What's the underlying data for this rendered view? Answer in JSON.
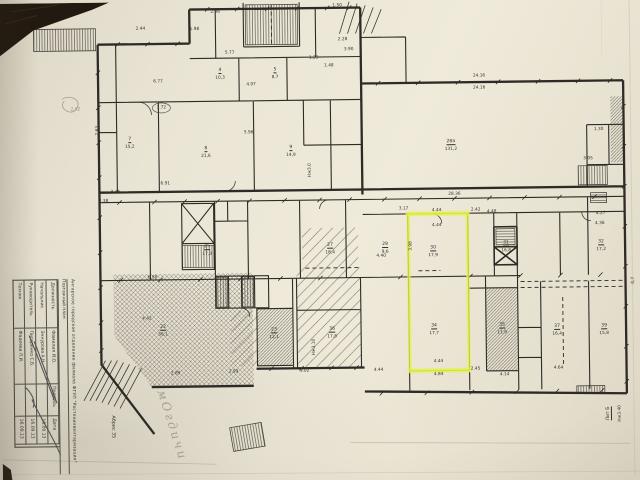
{
  "photo": {
    "background_color": "#1e1811",
    "paper_color": "#eae5d5",
    "ink_color": "#2e2b26",
    "highlight_color": "#e4f450"
  },
  "annotations": {
    "handwritten_note": "мОгдичи"
  },
  "titleblock": {
    "org_line": "Ангарское городское отделение филиала ФГУП \"Ростехинвентаризация\"",
    "doc_line": "Поэтажный план",
    "headers": [
      "Должность",
      "Фамилия И.О.",
      "Подпись",
      "Дата"
    ],
    "rows": [
      {
        "role": "Начальник",
        "name": "Эннурова А.Н.",
        "sign": "",
        "date": "16.09.13"
      },
      {
        "role": "Руководитель",
        "name": "Пигоренко С.Б.",
        "sign": "",
        "date": "16.09.13"
      },
      {
        "role": "Техник",
        "name": "Фадеева Л.И.",
        "sign": "",
        "date": "16.09.13"
      }
    ],
    "abris": "Абрис 35"
  },
  "plan": {
    "labels": [
      {
        "t": "2.86",
        "x": 218,
        "y": 11
      },
      {
        "t": "1.50",
        "x": 340,
        "y": 6
      },
      {
        "t": "2.44",
        "x": 143,
        "y": 27
      },
      {
        "t": "1.98",
        "x": 197,
        "y": 28
      },
      {
        "t": "2.28",
        "x": 345,
        "y": 40
      },
      {
        "t": "3.90",
        "x": 351,
        "y": 50
      },
      {
        "t": "5.77",
        "x": 232,
        "y": 52
      },
      {
        "t": "1.23",
        "x": 316,
        "y": 58
      },
      {
        "t": "1.48",
        "x": 331,
        "y": 66
      },
      {
        "t": "4",
        "x": 222,
        "y": 70,
        "c": "rm"
      },
      {
        "t": "10,3",
        "x": 222,
        "y": 77
      },
      {
        "t": "5",
        "x": 277,
        "y": 70,
        "c": "rm"
      },
      {
        "t": "8,7",
        "x": 277,
        "y": 77
      },
      {
        "t": "6.77",
        "x": 160,
        "y": 80
      },
      {
        "t": "4.97",
        "x": 253,
        "y": 84
      },
      {
        "t": "24.16",
        "x": 481,
        "y": 78
      },
      {
        "t": "24.16",
        "x": 481,
        "y": 90
      },
      {
        "t": "1,92",
        "x": 77,
        "y": 107,
        "c": "pencil"
      },
      {
        "t": "1.72",
        "x": 163,
        "y": 106
      },
      {
        "t": "2.63",
        "x": 99,
        "y": 128,
        "r": -90
      },
      {
        "t": "5.96",
        "x": 250,
        "y": 132
      },
      {
        "t": "1.30",
        "x": 600,
        "y": 133
      },
      {
        "t": "7",
        "x": 131,
        "y": 138,
        "c": "rm"
      },
      {
        "t": "15,2",
        "x": 131,
        "y": 145
      },
      {
        "t": "28а",
        "x": 452,
        "y": 144,
        "c": "rm"
      },
      {
        "t": "131,2",
        "x": 452,
        "y": 151
      },
      {
        "t": "8",
        "x": 207,
        "y": 148,
        "c": "rm"
      },
      {
        "t": "21,6",
        "x": 207,
        "y": 155
      },
      {
        "t": "9",
        "x": 292,
        "y": 148,
        "c": "rm"
      },
      {
        "t": "14,9",
        "x": 292,
        "y": 155
      },
      {
        "t": "3.05",
        "x": 589,
        "y": 162
      },
      {
        "t": "Нж3.0",
        "x": 311,
        "y": 170,
        "r": -90
      },
      {
        "t": "6.91",
        "x": 166,
        "y": 182
      },
      {
        "t": "3.45",
        "x": 116,
        "y": 190
      },
      {
        "t": "2.38",
        "x": 104,
        "y": 199
      },
      {
        "t": "28.36",
        "x": 455,
        "y": 196
      },
      {
        "t": "3.17",
        "x": 404,
        "y": 210
      },
      {
        "t": "4.44",
        "x": 437,
        "y": 212
      },
      {
        "t": "2.42",
        "x": 476,
        "y": 212
      },
      {
        "t": "4.48",
        "x": 492,
        "y": 214
      },
      {
        "t": "4.27",
        "x": 601,
        "y": 217
      },
      {
        "t": "4.36",
        "x": 600,
        "y": 227
      },
      {
        "t": "4.44",
        "x": 437,
        "y": 227
      },
      {
        "t": "25",
        "x": 207,
        "y": 246,
        "c": "rm"
      },
      {
        "t": "17,3",
        "x": 207,
        "y": 253
      },
      {
        "t": "27",
        "x": 330,
        "y": 246,
        "c": "rm"
      },
      {
        "t": "18,4",
        "x": 330,
        "y": 253
      },
      {
        "t": "29",
        "x": 385,
        "y": 246,
        "c": "rm"
      },
      {
        "t": "9,6",
        "x": 385,
        "y": 253
      },
      {
        "t": "30",
        "x": 433,
        "y": 250,
        "c": "rm"
      },
      {
        "t": "17,9",
        "x": 433,
        "y": 257
      },
      {
        "t": "31",
        "x": 506,
        "y": 246,
        "c": "rm"
      },
      {
        "t": "16,8",
        "x": 506,
        "y": 253
      },
      {
        "t": "32",
        "x": 601,
        "y": 246,
        "c": "rm"
      },
      {
        "t": "17,2",
        "x": 601,
        "y": 253
      },
      {
        "t": "3.98",
        "x": 411,
        "y": 247,
        "r": -90
      },
      {
        "t": "4.40",
        "x": 381,
        "y": 257
      },
      {
        "t": "0,7",
        "x": 633,
        "y": 284,
        "r": -90
      },
      {
        "t": "6.58",
        "x": 152,
        "y": 276
      },
      {
        "t": "22",
        "x": 162,
        "y": 326,
        "c": "rm"
      },
      {
        "t": "56,1",
        "x": 162,
        "y": 333
      },
      {
        "t": "4.42",
        "x": 146,
        "y": 317
      },
      {
        "t": "23",
        "x": 273,
        "y": 330,
        "c": "rm"
      },
      {
        "t": "12,1",
        "x": 273,
        "y": 337
      },
      {
        "t": "36",
        "x": 331,
        "y": 330,
        "c": "rm"
      },
      {
        "t": "17,8",
        "x": 331,
        "y": 337
      },
      {
        "t": "34",
        "x": 433,
        "y": 328,
        "c": "rm"
      },
      {
        "t": "17,7",
        "x": 433,
        "y": 335
      },
      {
        "t": "35",
        "x": 501,
        "y": 328,
        "c": "rm"
      },
      {
        "t": "11,9",
        "x": 501,
        "y": 335
      },
      {
        "t": "37",
        "x": 556,
        "y": 330,
        "c": "rm"
      },
      {
        "t": "16,4",
        "x": 556,
        "y": 337
      },
      {
        "t": "39",
        "x": 603,
        "y": 330,
        "c": "rm"
      },
      {
        "t": "15,8",
        "x": 603,
        "y": 337
      },
      {
        "t": "Нж3.10",
        "x": 313,
        "y": 347,
        "r": -90
      },
      {
        "t": "2.89",
        "x": 174,
        "y": 372
      },
      {
        "t": "2.99",
        "x": 232,
        "y": 371
      },
      {
        "t": "9.02",
        "x": 303,
        "y": 371
      },
      {
        "t": "4.44",
        "x": 377,
        "y": 371
      },
      {
        "t": "4.44",
        "x": 437,
        "y": 363
      },
      {
        "t": "4.84",
        "x": 437,
        "y": 376
      },
      {
        "t": "2.45",
        "x": 474,
        "y": 371
      },
      {
        "t": "4.14",
        "x": 503,
        "y": 377
      },
      {
        "t": "4.64",
        "x": 557,
        "y": 371
      },
      {
        "t": "Лит Б",
        "x": 607,
        "y": 417,
        "r": -90,
        "c": "rm"
      },
      {
        "t": "Нж3.40",
        "x": 618,
        "y": 417,
        "r": -90
      }
    ]
  }
}
